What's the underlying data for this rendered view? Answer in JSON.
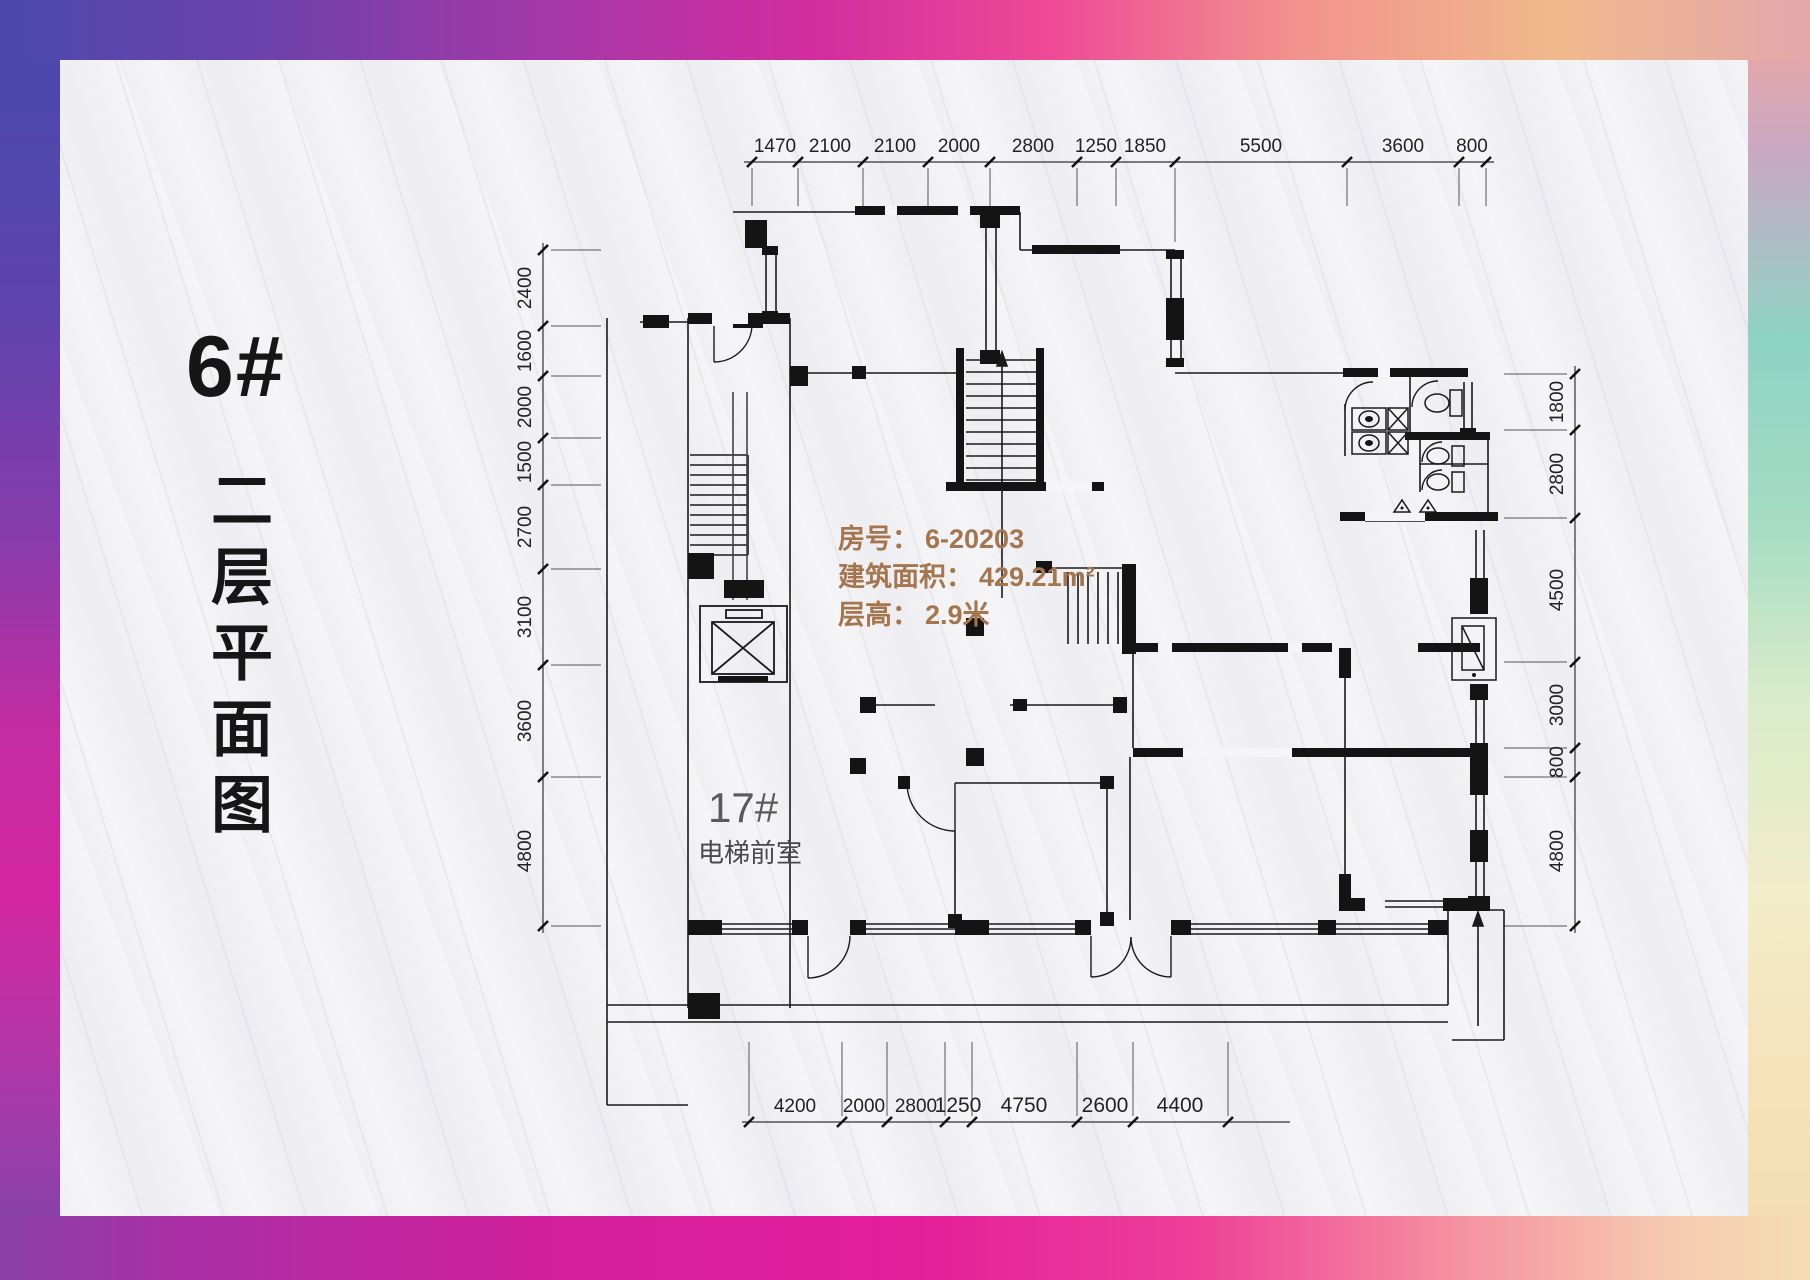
{
  "page": {
    "background": "#f5f5f7"
  },
  "frame": {
    "corner_top_left": "#4c49ab",
    "top_mid": "#d32d9f",
    "corner_top_right": "#e3a7ab",
    "right_teal": "#8ed3c3",
    "corner_bottom_right": "#f4ddb2",
    "bottom_mid": "#e41d9b",
    "corner_bottom_left": "#8a41aa"
  },
  "title": {
    "building": "6#",
    "floor_text": "二层平面图"
  },
  "annotation": {
    "color": "#a5764d",
    "room_label": "房号：",
    "room_value": "6-20203",
    "area_label": "建筑面积：",
    "area_value": "429.21m²",
    "height_label": "层高：",
    "height_value": "2.9米"
  },
  "elevator": {
    "label": "17#",
    "lobby": "电梯前室"
  },
  "dims": {
    "top": [
      "1470",
      "2100",
      "2100",
      "2000",
      "2800",
      "1250",
      "1850",
      "5500",
      "3600",
      "800"
    ],
    "left": [
      "2400",
      "1600",
      "2000",
      "1500",
      "2700",
      "3100",
      "3600",
      "4800"
    ],
    "right": [
      "1800",
      "2800",
      "4500",
      "3000",
      "800",
      "4800"
    ],
    "bottom": [
      "4200",
      "2000",
      "2800",
      "1250",
      "4750",
      "2600",
      "4400"
    ]
  }
}
